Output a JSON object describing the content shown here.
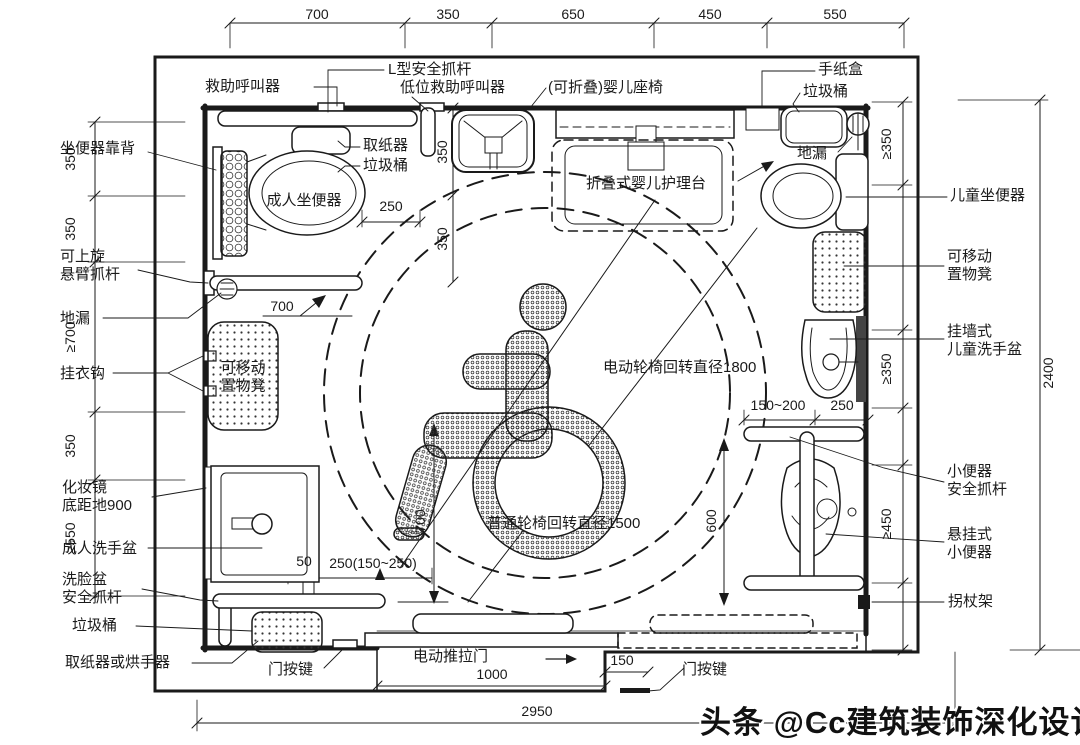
{
  "watermark": "头条 @Cc建筑装饰深化设计",
  "dims": {
    "top": [
      "700",
      "350",
      "650",
      "450",
      "550"
    ],
    "left": [
      "350",
      "350",
      "≥700",
      "350",
      "≥550"
    ],
    "right_inner": [
      "≥350",
      "≥350",
      "≥450"
    ],
    "overall_width": "2950",
    "overall_height": "2400",
    "door_width": "1000",
    "door_step": "150",
    "toilet_side": "250",
    "seat_off": [
      "350",
      "350"
    ],
    "transfer": "700",
    "basin_front": "700",
    "basin_edge": "50",
    "basin_range": "250(150~250)",
    "urinal_range": "150~200",
    "urinal_side": "250",
    "urinal_span": "600"
  },
  "labels": {
    "rescue_call": "救助呼叫器",
    "l_grab_bar": "L型安全抓杆",
    "low_rescue_call": "低位救助呼叫器",
    "baby_seat": "(可折叠)婴儿座椅",
    "tissue_box": "手纸盒",
    "trash_top_right": "垃圾桶",
    "floor_drain_right": "地漏",
    "toilet_backrest": "坐便器靠背",
    "adult_toilet": "成人坐便器",
    "paper_dispenser": "取纸器",
    "trash_small": "垃圾桶",
    "swing_grab_bar": "可上旋\n悬臂抓杆",
    "floor_drain_left": "地漏",
    "clothes_hook": "挂衣钩",
    "stool_left": "可移动\n置物凳",
    "mirror": "化妆镜\n底距地900",
    "adult_basin": "成人洗手盆",
    "basin_grab_bar": "洗脸盆\n安全抓杆",
    "trash_bottom_left": "垃圾桶",
    "paper_or_dryer": "取纸器或烘手器",
    "door_button_left": "门按键",
    "door_button_right": "门按键",
    "sliding_door": "电动推拉门",
    "care_table": "折叠式婴儿护理台",
    "child_toilet": "儿童坐便器",
    "stool_right": "可移动\n置物凳",
    "child_basin": "挂墙式\n儿童洗手盆",
    "urinal_grab": "小便器\n安全抓杆",
    "urinal": "悬挂式\n小便器",
    "crutch_rack": "拐杖架",
    "circle_1800": "电动轮椅回转直径1800",
    "circle_1500": "普通轮椅回转直径1500"
  }
}
